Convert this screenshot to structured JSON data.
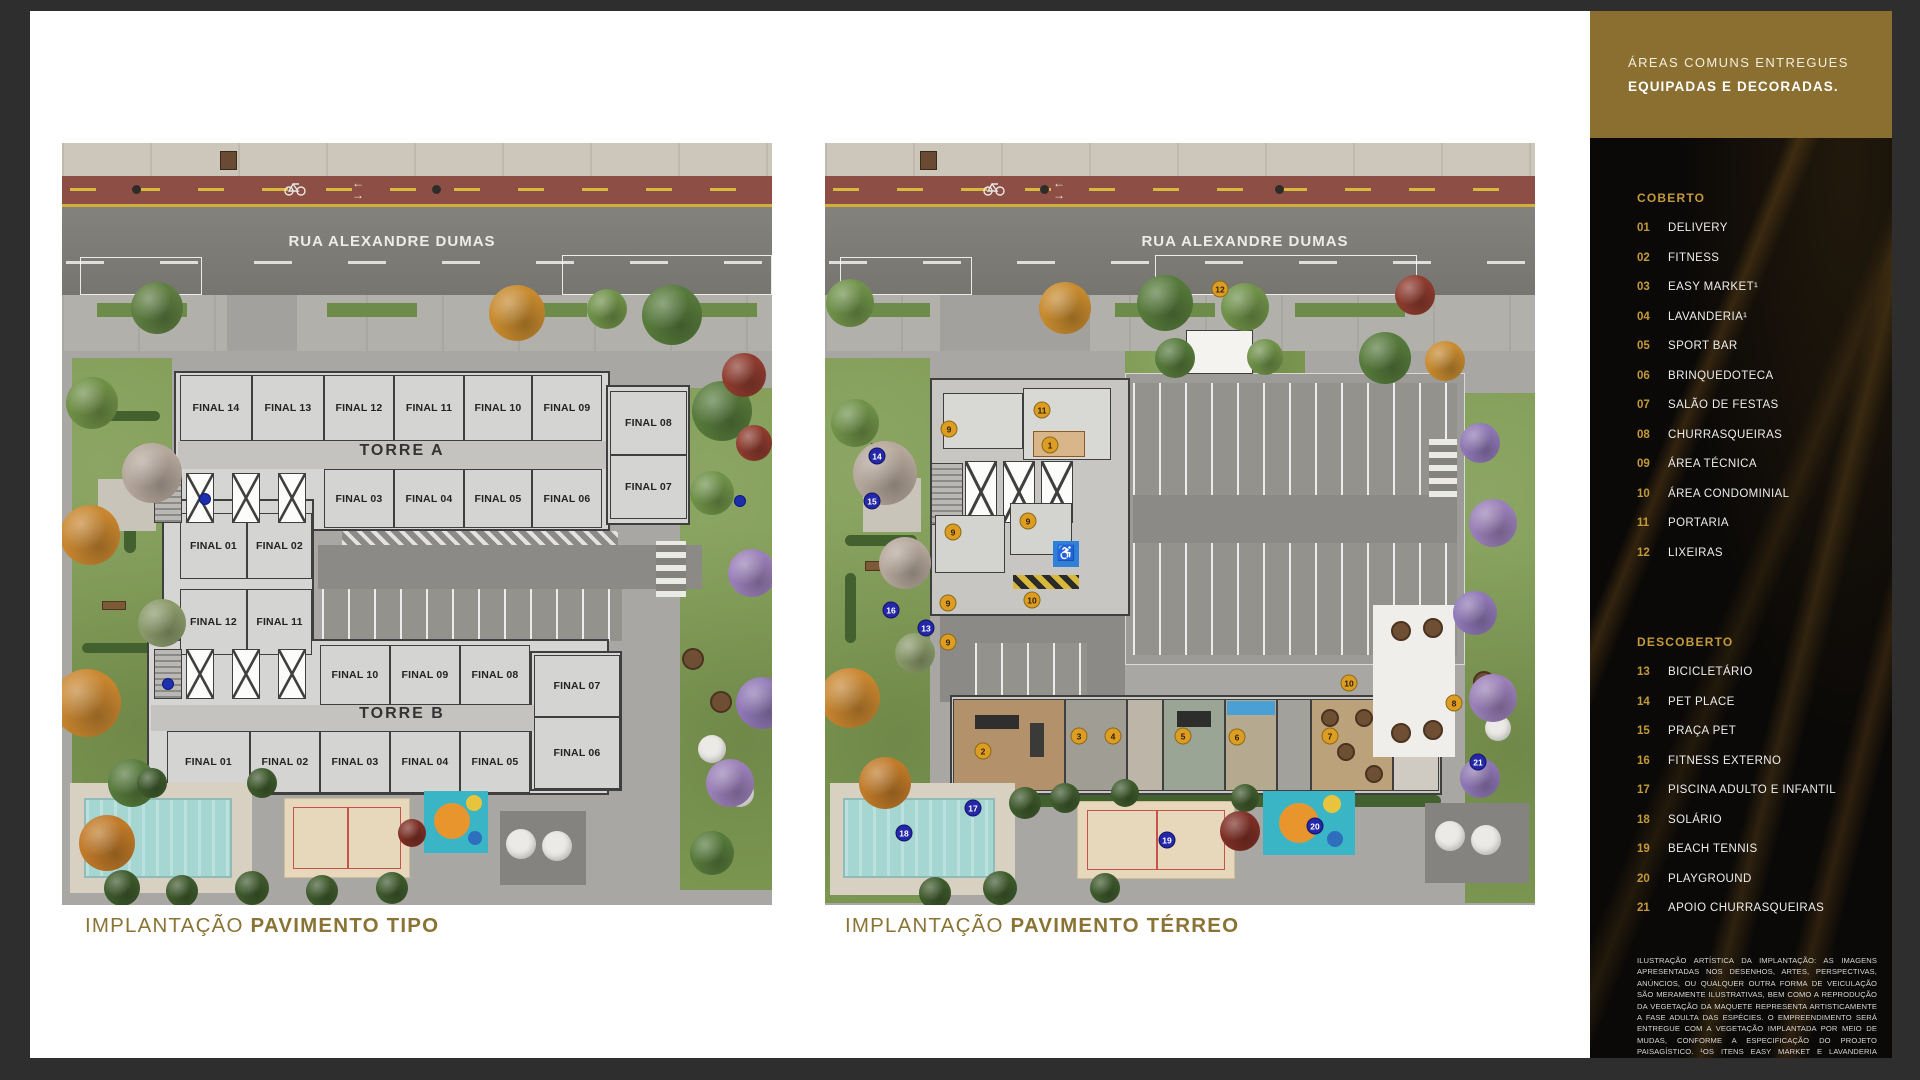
{
  "slide": {
    "background": "#ffffff",
    "viewer_background": "#2e2e2e"
  },
  "captions": {
    "color": "#8a7334",
    "left": {
      "regular": "IMPLANTAÇÃO",
      "bold": "PAVIMENTO TIPO"
    },
    "right": {
      "regular": "IMPLANTAÇÃO",
      "bold": "PAVIMENTO TÉRREO"
    }
  },
  "sidebar": {
    "header": {
      "line1": "ÁREAS COMUNS ENTREGUES",
      "line2": "EQUIPADAS E DECORADAS.",
      "background": "#8a6f30"
    },
    "accent_color": "#c49a38",
    "sections": [
      {
        "title": "COBERTO",
        "items": [
          {
            "n": "01",
            "label": "DELIVERY"
          },
          {
            "n": "02",
            "label": "FITNESS"
          },
          {
            "n": "03",
            "label": "EASY MARKET¹"
          },
          {
            "n": "04",
            "label": "LAVANDERIA¹"
          },
          {
            "n": "05",
            "label": "SPORT BAR"
          },
          {
            "n": "06",
            "label": "BRINQUEDOTECA"
          },
          {
            "n": "07",
            "label": "SALÃO DE FESTAS"
          },
          {
            "n": "08",
            "label": "CHURRASQUEIRAS"
          },
          {
            "n": "09",
            "label": "ÁREA TÉCNICA"
          },
          {
            "n": "10",
            "label": "ÁREA CONDOMINIAL"
          },
          {
            "n": "11",
            "label": "PORTARIA"
          },
          {
            "n": "12",
            "label": "LIXEIRAS"
          }
        ]
      },
      {
        "title": "DESCOBERTO",
        "items": [
          {
            "n": "13",
            "label": "BICICLETÁRIO"
          },
          {
            "n": "14",
            "label": "PET PLACE"
          },
          {
            "n": "15",
            "label": "PRAÇA PET"
          },
          {
            "n": "16",
            "label": "FITNESS EXTERNO"
          },
          {
            "n": "17",
            "label": "PISCINA ADULTO E INFANTIL"
          },
          {
            "n": "18",
            "label": "SOLÁRIO"
          },
          {
            "n": "19",
            "label": "BEACH TENNIS"
          },
          {
            "n": "20",
            "label": "PLAYGROUND"
          },
          {
            "n": "21",
            "label": "APOIO CHURRASQUEIRAS"
          }
        ]
      }
    ],
    "disclaimer": "ILUSTRAÇÃO ARTÍSTICA DA IMPLANTAÇÃO: AS IMAGENS APRESENTADAS NOS DESENHOS, ARTES, PERSPECTIVAS, ANÚNCIOS, OU QUALQUER OUTRA FORMA DE VEICULAÇÃO SÃO MERAMENTE ILUSTRATIVAS, BEM COMO A REPRODUÇÃO DA VEGETAÇÃO DA MAQUETE REPRESENTA ARTISTICAMENTE A FASE ADULTA DAS ESPÉCIES. O EMPREENDIMENTO SERÁ ENTREGUE COM A VEGETAÇÃO IMPLANTADA POR MEIO DE MUDAS, CONFORME A ESPECIFICAÇÃO DO PROJETO PAISAGÍSTICO. ¹OS ITENS EASY MARKET E LAVANDERIA PODERÃO CONTAR COM PRESTAÇÃO DE SERVIÇO TERCEIRIZADO E INDEPENDENTE DA INCORPORADORA, SENDO SUA UTILIZAÇÃO MEDIANTE PAGAMENTO PELO CONDÔMINO (PAY-PER-USE)."
  },
  "plans": {
    "tipo": {
      "street": "RUA ALEXANDRE DUMAS",
      "towers": [
        {
          "label": "TORRE A",
          "x": 340,
          "y": 299
        },
        {
          "label": "TORRE B",
          "x": 340,
          "y": 562
        }
      ],
      "units": [
        {
          "label": "FINAL 14",
          "x": 118,
          "y": 232,
          "w": 72,
          "h": 66
        },
        {
          "label": "FINAL 13",
          "x": 190,
          "y": 232,
          "w": 72,
          "h": 66
        },
        {
          "label": "FINAL 12",
          "x": 262,
          "y": 232,
          "w": 70,
          "h": 66
        },
        {
          "label": "FINAL 11",
          "x": 332,
          "y": 232,
          "w": 70,
          "h": 66
        },
        {
          "label": "FINAL 10",
          "x": 402,
          "y": 232,
          "w": 68,
          "h": 66
        },
        {
          "label": "FINAL 09",
          "x": 470,
          "y": 232,
          "w": 70,
          "h": 66
        },
        {
          "label": "FINAL 08",
          "x": 548,
          "y": 248,
          "w": 77,
          "h": 64
        },
        {
          "label": "FINAL 07",
          "x": 548,
          "y": 312,
          "w": 77,
          "h": 64
        },
        {
          "label": "FINAL 03",
          "x": 262,
          "y": 326,
          "w": 70,
          "h": 59
        },
        {
          "label": "FINAL 04",
          "x": 332,
          "y": 326,
          "w": 70,
          "h": 59
        },
        {
          "label": "FINAL 05",
          "x": 402,
          "y": 326,
          "w": 68,
          "h": 59
        },
        {
          "label": "FINAL 06",
          "x": 470,
          "y": 326,
          "w": 70,
          "h": 59
        },
        {
          "label": "FINAL 01",
          "x": 118,
          "y": 370,
          "w": 67,
          "h": 66
        },
        {
          "label": "FINAL 02",
          "x": 185,
          "y": 370,
          "w": 65,
          "h": 66
        },
        {
          "label": "FINAL 12",
          "x": 118,
          "y": 446,
          "w": 67,
          "h": 66
        },
        {
          "label": "FINAL 11",
          "x": 185,
          "y": 446,
          "w": 65,
          "h": 66
        },
        {
          "label": "FINAL 10",
          "x": 258,
          "y": 502,
          "w": 70,
          "h": 60
        },
        {
          "label": "FINAL 09",
          "x": 328,
          "y": 502,
          "w": 70,
          "h": 60
        },
        {
          "label": "FINAL 08",
          "x": 398,
          "y": 502,
          "w": 70,
          "h": 60
        },
        {
          "label": "FINAL 07",
          "x": 472,
          "y": 512,
          "w": 86,
          "h": 62
        },
        {
          "label": "FINAL 06",
          "x": 472,
          "y": 574,
          "w": 86,
          "h": 72
        },
        {
          "label": "FINAL 01",
          "x": 105,
          "y": 588,
          "w": 83,
          "h": 62
        },
        {
          "label": "FINAL 02",
          "x": 188,
          "y": 588,
          "w": 70,
          "h": 62
        },
        {
          "label": "FINAL 03",
          "x": 258,
          "y": 588,
          "w": 70,
          "h": 62
        },
        {
          "label": "FINAL 04",
          "x": 328,
          "y": 588,
          "w": 70,
          "h": 62
        },
        {
          "label": "FINAL 05",
          "x": 398,
          "y": 588,
          "w": 70,
          "h": 62
        }
      ]
    },
    "terreo": {
      "street": "RUA ALEXANDRE DUMAS",
      "markers": [
        {
          "n": "12",
          "type": "gold",
          "x": 395,
          "y": 146
        },
        {
          "n": "11",
          "type": "gold",
          "x": 217,
          "y": 267
        },
        {
          "n": "9",
          "type": "gold",
          "x": 124,
          "y": 286
        },
        {
          "n": "1",
          "type": "gold",
          "x": 225,
          "y": 302
        },
        {
          "n": "9",
          "type": "gold",
          "x": 203,
          "y": 378
        },
        {
          "n": "9",
          "type": "gold",
          "x": 128,
          "y": 389
        },
        {
          "n": "9",
          "type": "gold",
          "x": 123,
          "y": 460
        },
        {
          "n": "9",
          "type": "gold",
          "x": 123,
          "y": 499
        },
        {
          "n": "10",
          "type": "gold",
          "x": 207,
          "y": 457
        },
        {
          "n": "10",
          "type": "gold",
          "x": 524,
          "y": 540
        },
        {
          "n": "2",
          "type": "gold",
          "x": 158,
          "y": 608
        },
        {
          "n": "3",
          "type": "gold",
          "x": 254,
          "y": 593
        },
        {
          "n": "4",
          "type": "gold",
          "x": 288,
          "y": 593
        },
        {
          "n": "5",
          "type": "gold",
          "x": 358,
          "y": 593
        },
        {
          "n": "6",
          "type": "gold",
          "x": 412,
          "y": 594
        },
        {
          "n": "7",
          "type": "gold",
          "x": 505,
          "y": 593
        },
        {
          "n": "8",
          "type": "gold",
          "x": 629,
          "y": 560
        },
        {
          "n": "14",
          "type": "blue",
          "x": 52,
          "y": 313
        },
        {
          "n": "15",
          "type": "blue",
          "x": 47,
          "y": 358
        },
        {
          "n": "16",
          "type": "blue",
          "x": 66,
          "y": 467
        },
        {
          "n": "13",
          "type": "blue",
          "x": 101,
          "y": 485
        },
        {
          "n": "17",
          "type": "blue",
          "x": 148,
          "y": 665
        },
        {
          "n": "18",
          "type": "blue",
          "x": 79,
          "y": 690
        },
        {
          "n": "19",
          "type": "blue",
          "x": 342,
          "y": 697
        },
        {
          "n": "20",
          "type": "blue",
          "x": 490,
          "y": 683
        },
        {
          "n": "21",
          "type": "blue",
          "x": 653,
          "y": 619
        }
      ]
    }
  },
  "colors": {
    "gold_header": "#8a6f30",
    "gold_accent": "#c49a38",
    "caption_gold": "#8a7334",
    "marker_gold": "#dd9d23",
    "marker_blue": "#2428a8",
    "bike_lane": "#8d4e46",
    "asphalt": "#7b7a75",
    "lawn": "#7f9b53",
    "pool": "#a5d6d2",
    "sand": "#e7d8bc"
  }
}
